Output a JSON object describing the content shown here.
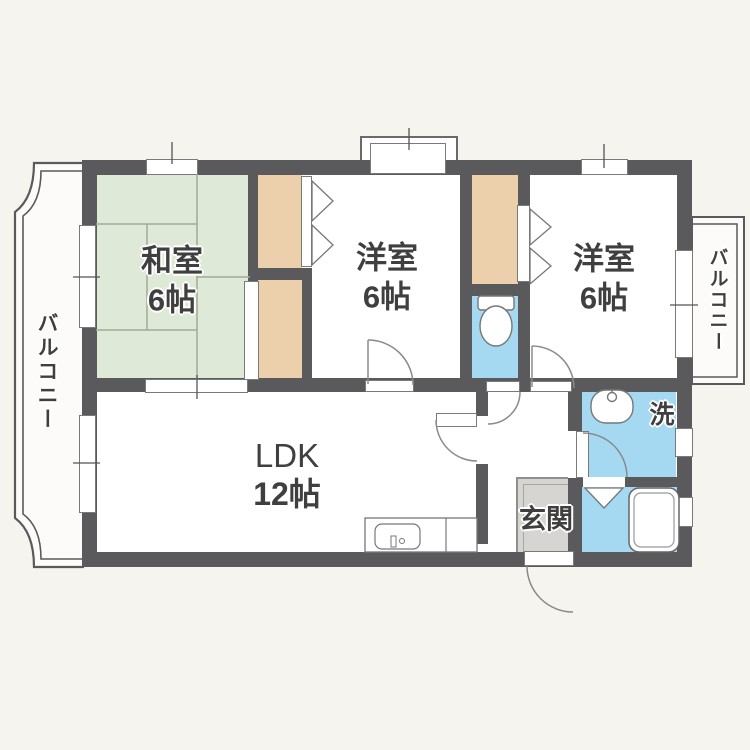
{
  "rooms": {
    "washitsu": {
      "label": "和室",
      "size": "6帖"
    },
    "bedroom_center": {
      "label": "洋室",
      "size": "6帖"
    },
    "bedroom_right": {
      "label": "洋室",
      "size": "6帖"
    },
    "ldk": {
      "label": "LDK",
      "size": "12帖"
    },
    "entrance": {
      "label": "玄関"
    },
    "laundry": {
      "label": "洗"
    },
    "balcony_left": {
      "label": "バルコニー"
    },
    "balcony_right": {
      "label": "バルコニー"
    }
  },
  "colors": {
    "wall": "#5a595b",
    "tatami_green": "#dfe9d8",
    "closet_beige": "#ecd0ac",
    "wet_area_blue": "#a5d9f2",
    "entrance_gray": "#d6d5d2",
    "room_white": "#ffffff",
    "background": "#f6f4ef"
  },
  "fixtures": [
    "toilet-icon",
    "washbasin-icon",
    "bathtub-icon",
    "kitchen-sink-icon",
    "washing-machine-space"
  ]
}
